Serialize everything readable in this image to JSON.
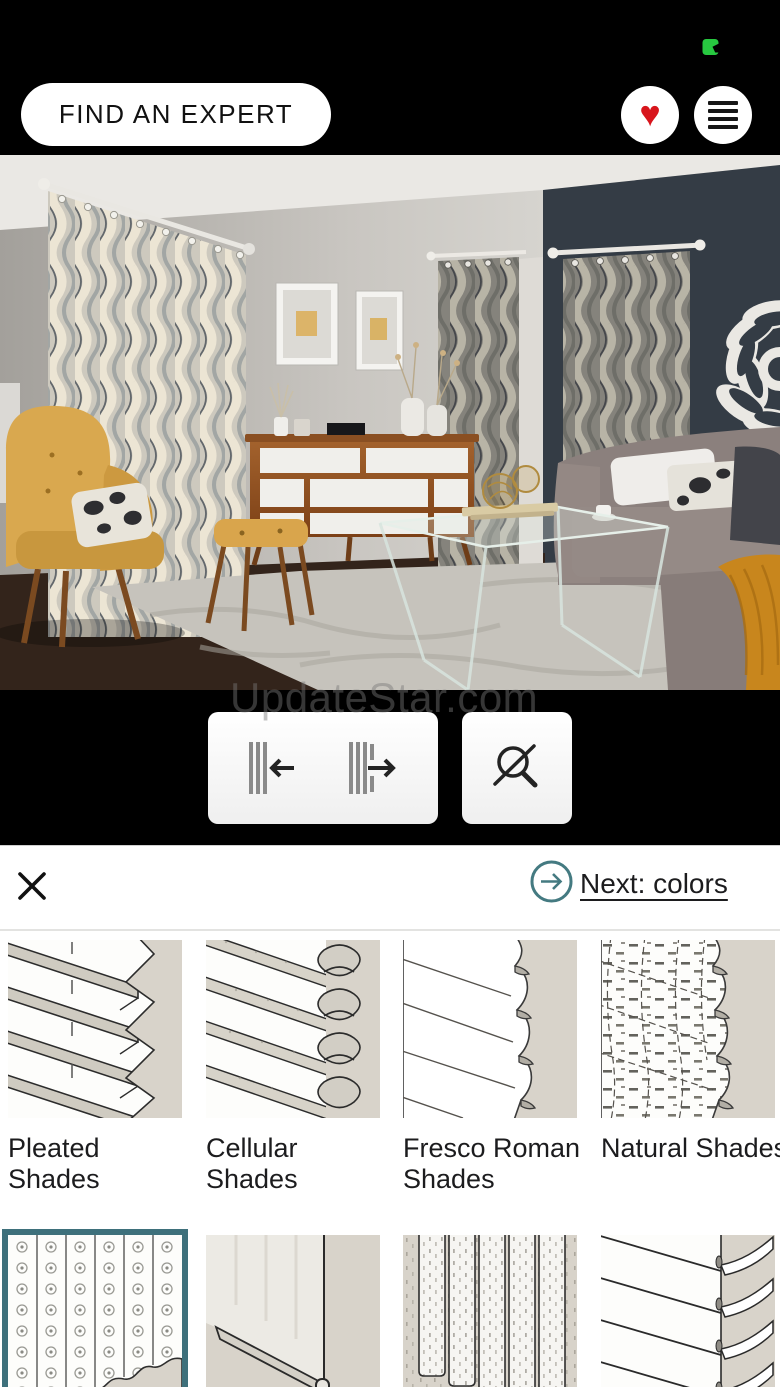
{
  "status_bar": {
    "app_indicator_icon": "green-app-indicator",
    "app_indicator_color": "#27c840"
  },
  "header": {
    "find_expert_label": "FIND AN EXPERT",
    "favorites_icon": "heart-icon",
    "menu_icon": "hamburger-menu-icon",
    "heart_glyph": "♥",
    "heart_color": "#d8151c"
  },
  "watermark": {
    "text": "UpdateStar.com"
  },
  "viewer": {
    "scene_description": "living room preview with patterned grommet drapery panels",
    "controls": {
      "close_drapes_icon": "drapes-close-left-icon",
      "open_drapes_icon": "drapes-open-right-icon",
      "zoom_off_icon": "magnifier-crossed-icon"
    }
  },
  "sheet": {
    "close_icon": "close-icon",
    "next_link": {
      "label": "Next: colors",
      "icon": "arrow-right-circle-icon",
      "accent_color": "#447a81"
    },
    "selected_border_color": "#3e707b",
    "tiles": [
      {
        "label": "Pleated Shades",
        "selected": false
      },
      {
        "label": "Cellular Shades",
        "selected": false
      },
      {
        "label": "Fresco Roman Shades",
        "selected": false
      },
      {
        "label": "Natural Shades",
        "selected": false
      },
      {
        "label": "",
        "selected": true
      },
      {
        "label": "",
        "selected": false
      },
      {
        "label": "",
        "selected": false
      },
      {
        "label": "",
        "selected": false
      }
    ]
  }
}
